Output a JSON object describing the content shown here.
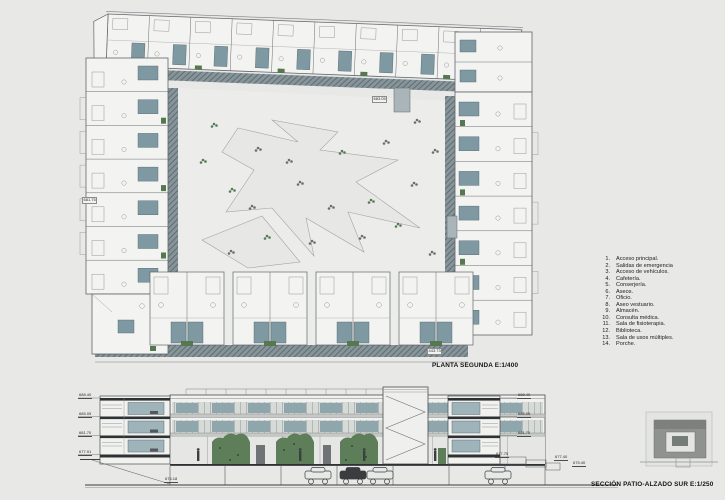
{
  "plan": {
    "caption": "PLANTA SEGUNDA E:1/400",
    "levels": [
      {
        "value": "683.05",
        "x": 372,
        "y": 96
      },
      {
        "value": "681.75",
        "x": 82,
        "y": 197
      },
      {
        "value": "443.73",
        "x": 427,
        "y": 348
      }
    ]
  },
  "legend": {
    "items": [
      {
        "num": "1.",
        "label": "Acceso principal."
      },
      {
        "num": "2.",
        "label": "Salidas de emergencia"
      },
      {
        "num": "3.",
        "label": "Acceso de vehículos."
      },
      {
        "num": "4.",
        "label": "Cafetería."
      },
      {
        "num": "5.",
        "label": "Conserjería."
      },
      {
        "num": "6.",
        "label": "Aseos."
      },
      {
        "num": "7.",
        "label": "Oficio."
      },
      {
        "num": "8.",
        "label": "Aseo vestuario."
      },
      {
        "num": "9.",
        "label": "Almacén."
      },
      {
        "num": "10.",
        "label": "Consulta médica."
      },
      {
        "num": "11.",
        "label": "Sala de fisioterapia."
      },
      {
        "num": "12.",
        "label": "Biblioteca."
      },
      {
        "num": "13.",
        "label": "Sala de usos múltiples."
      },
      {
        "num": "14.",
        "label": "Porche."
      }
    ]
  },
  "section": {
    "caption": "SECCIÓN PATIO-ALZADO SUR E:1/250",
    "levels": [
      {
        "value": "688.40",
        "x": 78,
        "y": 393
      },
      {
        "value": "685.05",
        "x": 78,
        "y": 412
      },
      {
        "value": "681.70",
        "x": 78,
        "y": 431
      },
      {
        "value": "677.91",
        "x": 78,
        "y": 450
      },
      {
        "value": "688.40",
        "x": 517,
        "y": 393
      },
      {
        "value": "685.05",
        "x": 517,
        "y": 412
      },
      {
        "value": "681.70",
        "x": 517,
        "y": 431
      },
      {
        "value": "677.75",
        "x": 495,
        "y": 452
      },
      {
        "value": "677.40",
        "x": 554,
        "y": 455
      },
      {
        "value": "675.40",
        "x": 572,
        "y": 461
      },
      {
        "value": "674.18",
        "x": 164,
        "y": 477
      }
    ]
  },
  "colors": {
    "background": "#e8e9e6",
    "room_fill": "#f3f3f1",
    "core_teal": "#7f99a3",
    "glass_teal": "#8fa6ad",
    "green": "#55784f",
    "hatch_base": "#87959a",
    "hatch_line": "#5d6d72",
    "line": "#55585a",
    "cut_dark": "#2f3234"
  }
}
